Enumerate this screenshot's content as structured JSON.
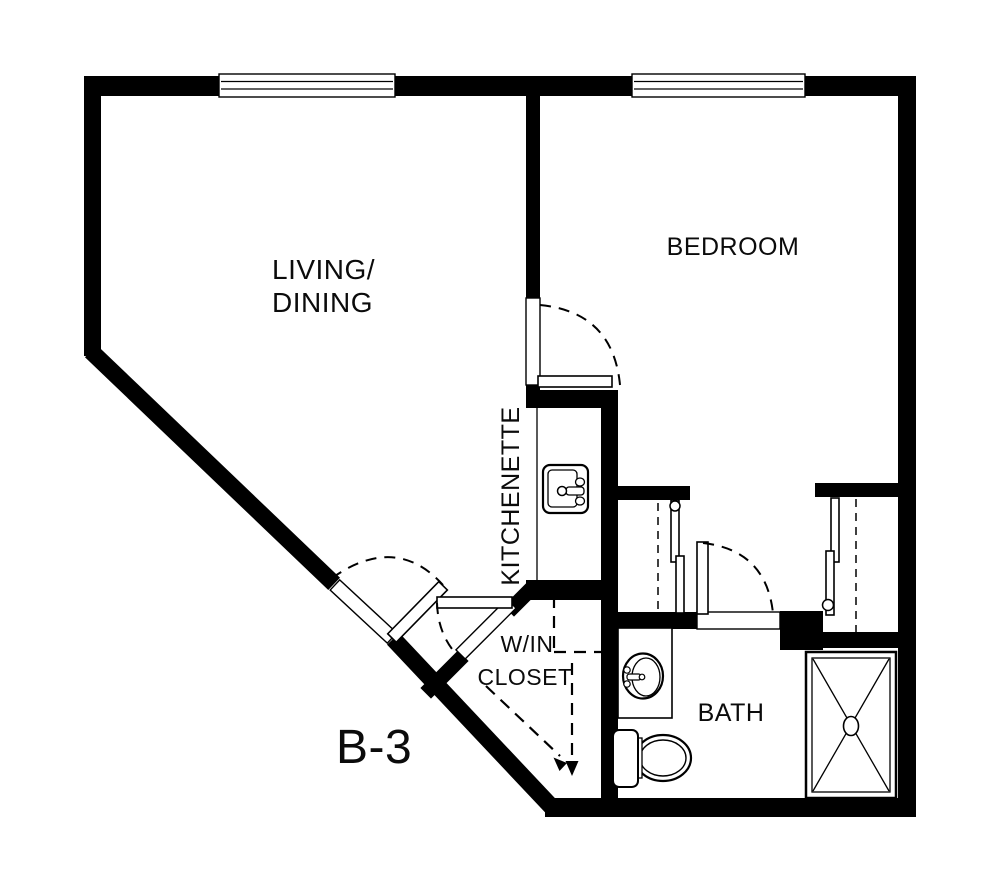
{
  "plan": {
    "unit_label": "B-3",
    "rooms": {
      "living_dining": {
        "line1": "LIVING/",
        "line2": "DINING"
      },
      "bedroom": {
        "label": "BEDROOM"
      },
      "kitchenette": {
        "label": "KITCHENETTE"
      },
      "win_closet": {
        "line1": "W/IN",
        "line2": "CLOSET"
      },
      "bath": {
        "label": "BATH"
      }
    },
    "fixtures": {
      "kitchen_sink": "kitchen-sink",
      "bathroom_sink": "bathroom-sink",
      "toilet": "toilet",
      "shower": "shower",
      "closet_left": "bypass-closet",
      "closet_right": "bypass-closet"
    },
    "colors": {
      "wall": "#000000",
      "background": "#ffffff"
    }
  }
}
